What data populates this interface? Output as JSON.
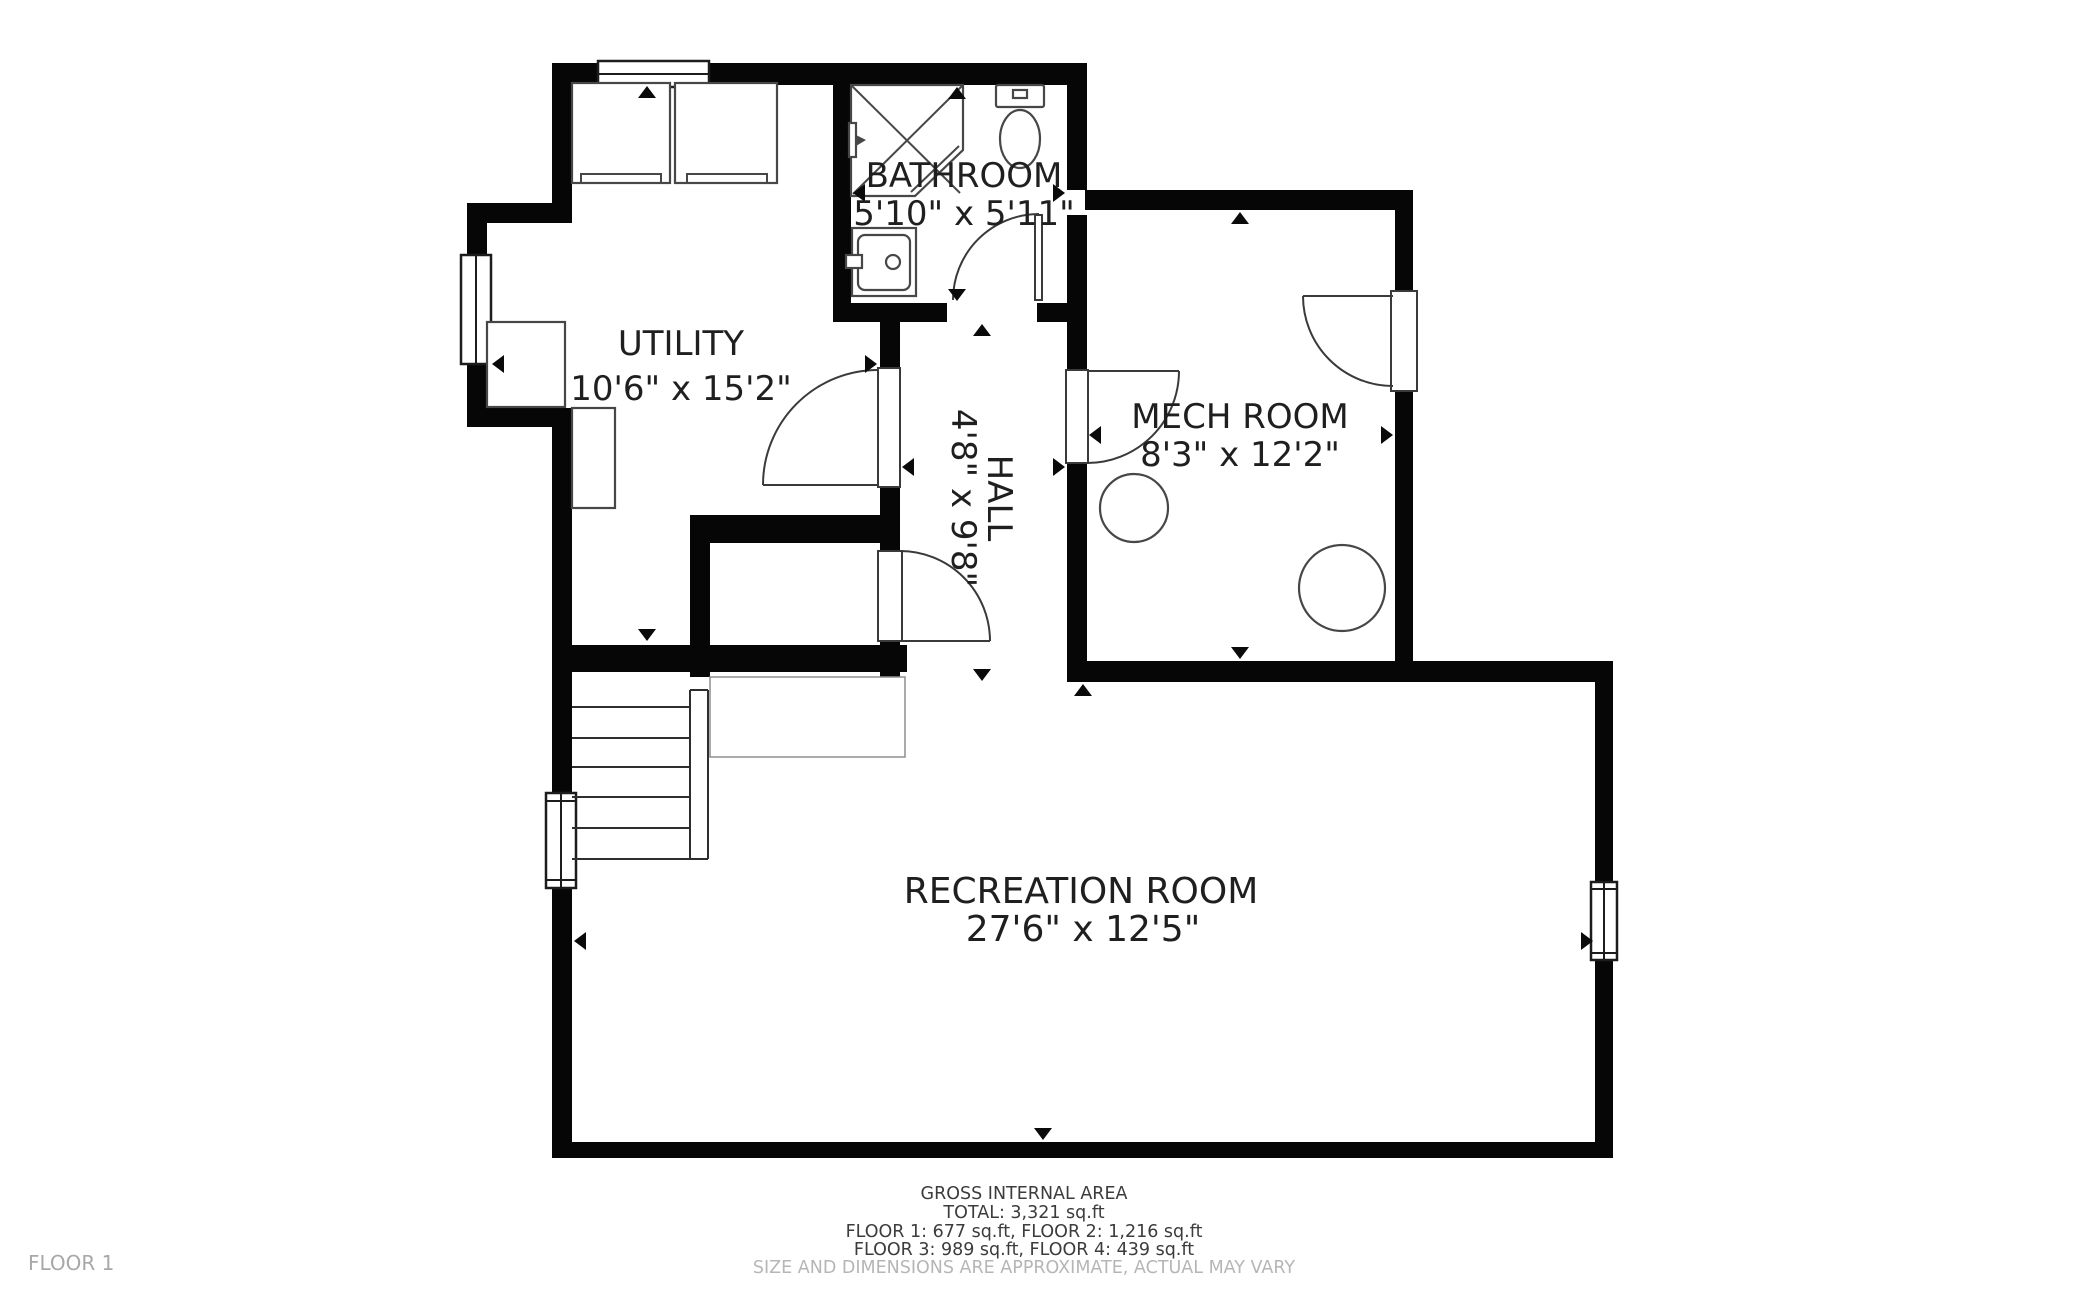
{
  "floor_label": "FLOOR 1",
  "rooms": [
    {
      "id": "bathroom",
      "name": "BATHROOM",
      "dimensions": "5'10\" x 5'11\""
    },
    {
      "id": "utility",
      "name": "UTILITY",
      "dimensions": "10'6\" x 15'2\""
    },
    {
      "id": "hall",
      "name": "HALL",
      "dimensions": "4'8\" x 9'8\""
    },
    {
      "id": "mech-room",
      "name": "MECH ROOM",
      "dimensions": "8'3\" x 12'2\""
    },
    {
      "id": "recreation-room",
      "name": "RECREATION ROOM",
      "dimensions": "27'6\" x 12'5\""
    }
  ],
  "footer": {
    "heading": "GROSS INTERNAL AREA",
    "total": "TOTAL: 3,321 sq.ft",
    "floors_line_1": "FLOOR 1: 677 sq.ft, FLOOR 2: 1,216 sq.ft",
    "floors_line_2": "FLOOR 3: 989 sq.ft, FLOOR 4: 439 sq.ft",
    "disclaimer": "SIZE AND DIMENSIONS ARE APPROXIMATE, ACTUAL MAY VARY"
  },
  "colors": {
    "wall": "#060606",
    "background": "#ffffff",
    "room_label": "#1f1f1f",
    "footer_text": "#3c3c3c",
    "muted_text": "#b6b6b6",
    "floor_label_text": "#a8a8a8",
    "fixture_line": "#474747"
  }
}
